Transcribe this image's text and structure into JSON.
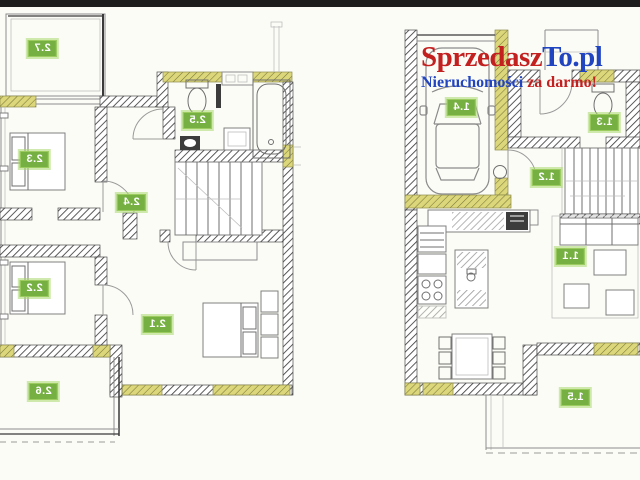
{
  "watermark": {
    "line1_part1": "Sprzedasz",
    "line1_part2": "To.pl",
    "line2_part1": "Nieruchomości ",
    "line2_part2": "za darmo!",
    "red": "#c32020",
    "blue": "#2144c0"
  },
  "plans": {
    "left": {
      "name": "upper floor plan",
      "rooms": [
        {
          "label": "2.7"
        },
        {
          "label": "2.3"
        },
        {
          "label": "2.4"
        },
        {
          "label": "2.5"
        },
        {
          "label": "2.2"
        },
        {
          "label": "2.1"
        },
        {
          "label": "2.6"
        }
      ]
    },
    "right": {
      "name": "ground floor plan",
      "rooms": [
        {
          "label": "1.4"
        },
        {
          "label": "1.3"
        },
        {
          "label": "1.2"
        },
        {
          "label": "1.1"
        },
        {
          "label": "1.5"
        }
      ]
    }
  },
  "colors": {
    "label_background": "#76b043",
    "label_text": "#ffffff",
    "wall_hatch": "#4a4a4a",
    "window_highlight": "#dcd77a",
    "top_bar": "#1d1d1d",
    "background": "#fcfcf7"
  }
}
